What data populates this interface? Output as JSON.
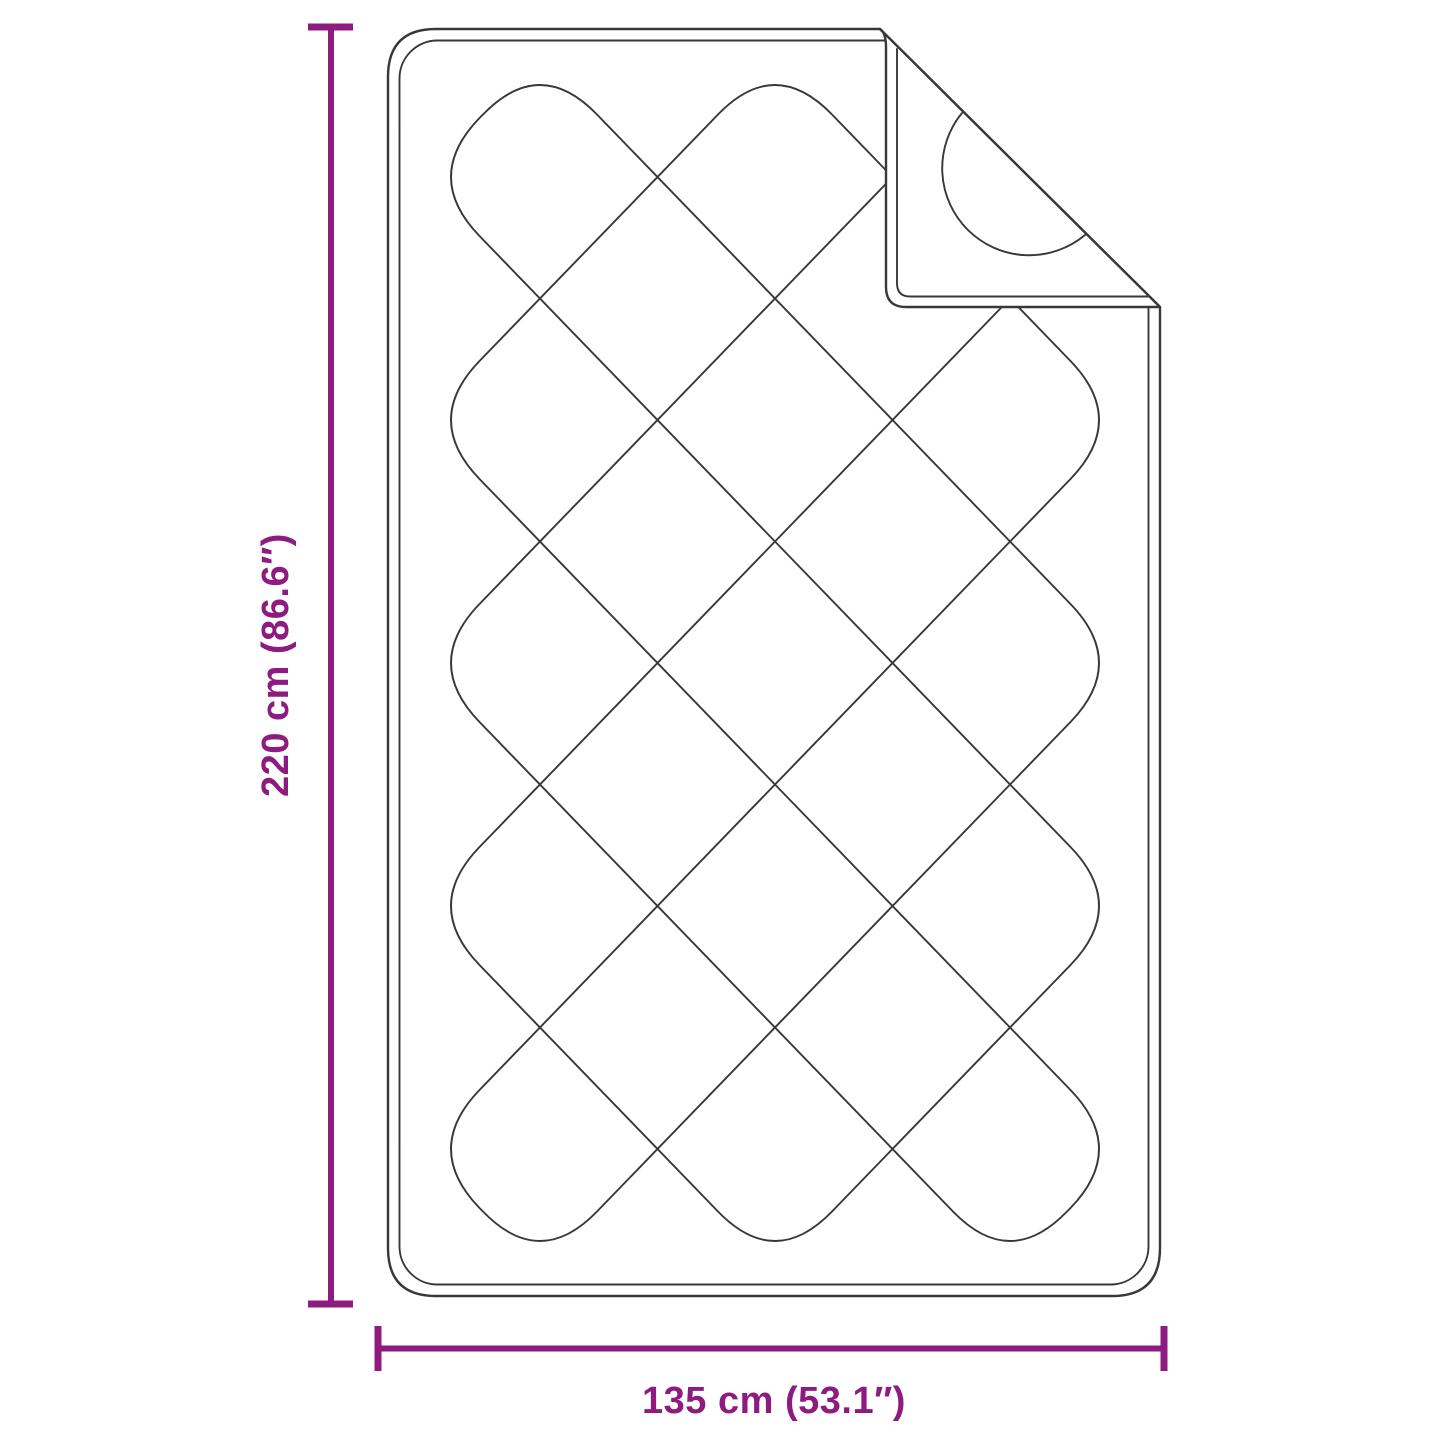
{
  "theme": {
    "accent": "#8E1B80",
    "line": "#383838",
    "background": "#FFFFFF"
  },
  "subject": {
    "name": "quilted blanket with folded corner",
    "pattern": "diamond quilting"
  },
  "dimensions": {
    "height": {
      "label": "220 cm (86.6″)",
      "value_cm": 220,
      "value_in": 86.6
    },
    "width": {
      "label": "135 cm (53.1″)",
      "value_cm": 135,
      "value_in": 53.1
    }
  }
}
